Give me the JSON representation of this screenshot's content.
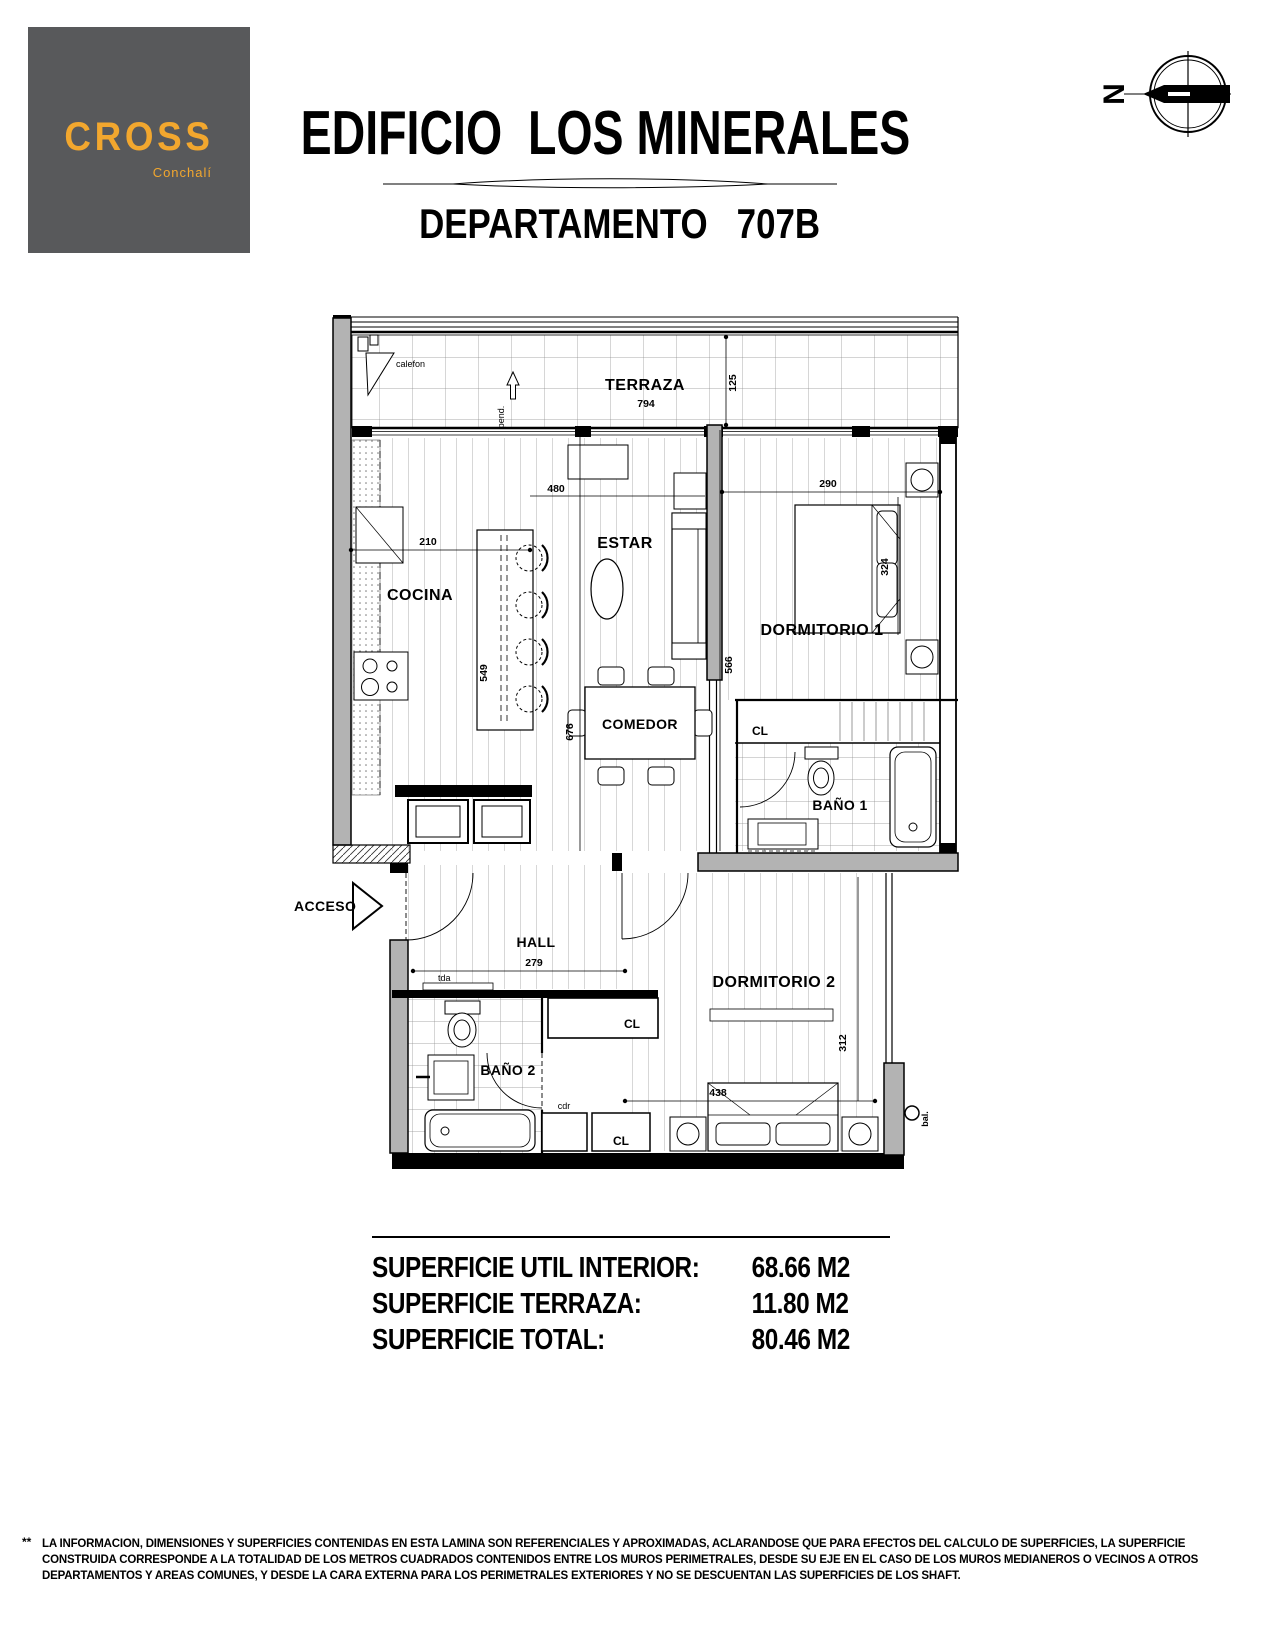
{
  "header": {
    "logo": {
      "brand": "CROSS",
      "location": "Conchalí"
    },
    "title": "EDIFICIO  LOS MINERALES",
    "subtitle": "DEPARTAMENTO   707B",
    "compass_north": "N"
  },
  "plan": {
    "rooms": {
      "terraza": "TERRAZA",
      "cocina": "COCINA",
      "estar": "ESTAR",
      "comedor": "COMEDOR",
      "dormitorio1": "DORMITORIO 1",
      "bano1": "BAÑO 1",
      "hall": "HALL",
      "bano2": "BAÑO 2",
      "dormitorio2": "DORMITORIO 2",
      "closet1": "CL",
      "closet2": "CL",
      "closet3": "CL"
    },
    "labels": {
      "acceso": "ACCESO",
      "calefon": "calefon",
      "pend": "pend.",
      "tda": "tda",
      "cdr": "cdr",
      "bal": "bal."
    },
    "dims": {
      "d794": "794",
      "d125": "125",
      "d210": "210",
      "d549": "549",
      "d480": "480",
      "d676": "676",
      "d566": "566",
      "d290": "290",
      "d324": "324",
      "d279": "279",
      "d438": "438",
      "d312": "312"
    }
  },
  "areas": {
    "rows": [
      {
        "label": "SUPERFICIE UTIL INTERIOR:",
        "value": "68.66 M2"
      },
      {
        "label": "SUPERFICIE TERRAZA:",
        "value": "11.80 M2"
      },
      {
        "label": "SUPERFICIE TOTAL:",
        "value": "80.46 M2"
      }
    ]
  },
  "footnote": {
    "marker": "**",
    "lines": [
      "LA INFORMACION, DIMENSIONES Y SUPERFICIES CONTENIDAS EN ESTA LAMINA SON REFERENCIALES Y APROXIMADAS, ACLARANDOSE QUE PARA EFECTOS DEL CALCULO DE SUPERFICIES,  LA  SUPERFICIE",
      "CONSTRUIDA CORRESPONDE A LA TOTALIDAD DE LOS METROS CUADRADOS CONTENIDOS ENTRE LOS MUROS PERIMETRALES, DESDE SU EJE EN EL CASO DE LOS MUROS MEDIANEROS O VECINOS A OTROS",
      "DEPARTAMENTOS Y AREAS COMUNES, Y DESDE LA CARA EXTERNA PARA LOS PERIMETRALES EXTERIORES Y NO SE DESCUENTAN LAS SUPERFICIES DE LOS SHAFT."
    ]
  }
}
